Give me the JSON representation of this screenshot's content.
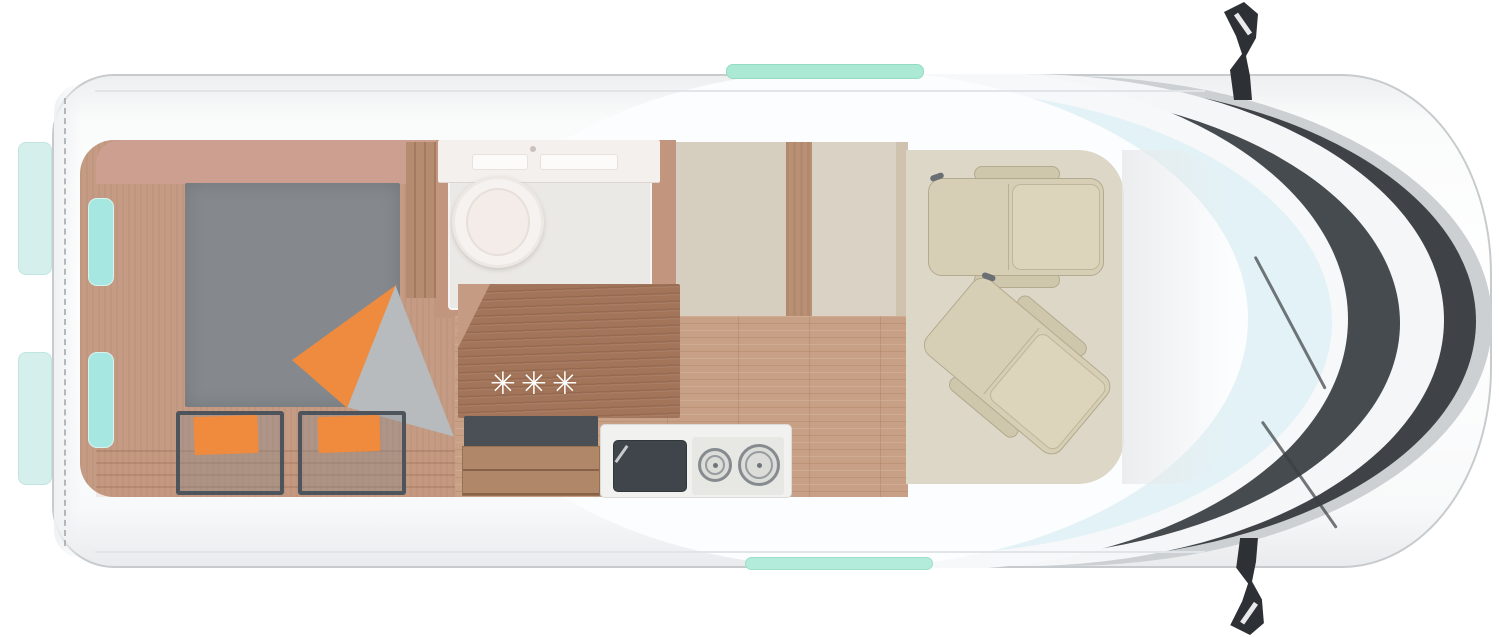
{
  "scene": {
    "subject": "camper van floor plan, top-down view",
    "front_direction": "right",
    "rooms_visible": [
      "rear bedroom with bed and two bench seats",
      "wardrobe",
      "bathroom with toilet and washbasin",
      "kitchen with counter, drawers, sink and two-burner hob",
      "corridor with wood floor",
      "cab with two swivel seats"
    ]
  },
  "kitchen": {
    "burner_star_symbol": "✳",
    "burner_star_count": 3
  },
  "palette": {
    "body_white": "#ffffff",
    "body_outline": "#c7cbce",
    "window_cyan": "#a6e7e1",
    "skylight_mint": "#abe9d4",
    "bed_gray": "#85898d",
    "cushion_orange": "#ef8c3f",
    "bench_frame": "#4d545b",
    "wood_tan": "#c59b84",
    "wood_floor": "#c7a085",
    "wood_counter": "#a2755a",
    "wall_beige": "#d6cfc0",
    "cab_seat_beige": "#d7cfb5",
    "glass_dark": "#464b50",
    "windshield_tint": "#e3f2f6",
    "mirror_black": "#2d3034"
  }
}
